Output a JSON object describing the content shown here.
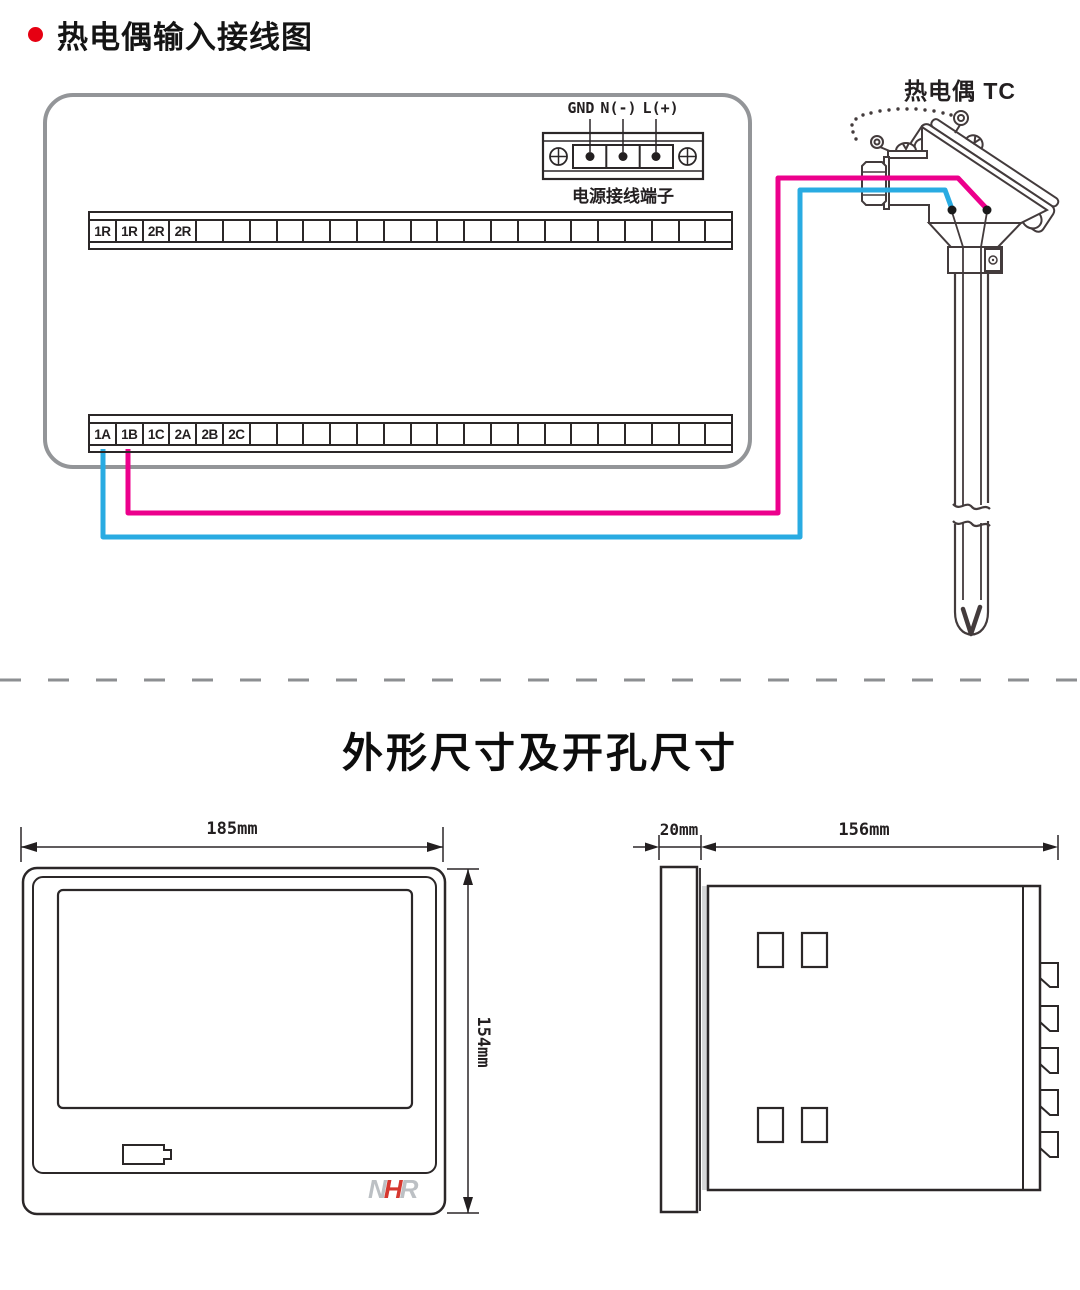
{
  "header": {
    "title": "热电偶输入接线图"
  },
  "wiring": {
    "power_labels": {
      "gnd": "GND",
      "neutral": "N(-)",
      "line": "L(+)"
    },
    "power_caption": "电源接线端子",
    "top_strip": {
      "cells": 24,
      "labels": [
        "1R",
        "1R",
        "2R",
        "2R"
      ]
    },
    "bottom_strip": {
      "cells": 24,
      "labels": [
        "1A",
        "1B",
        "1C",
        "2A",
        "2B",
        "2C"
      ]
    },
    "thermocouple_label": "热电偶 TC"
  },
  "dimensions_section": {
    "title": "外形尺寸及开孔尺寸",
    "front_view": {
      "width_label": "185mm",
      "height_label": "154mm",
      "logo": {
        "n": "N",
        "h": "H",
        "r": "R"
      }
    },
    "side_view": {
      "depth_label": "20mm",
      "body_label": "156mm"
    }
  },
  "colors": {
    "wire_cyan": "#29abe2",
    "wire_magenta": "#ec008c",
    "bullet_red": "#e60012",
    "panel_grey": "#939598",
    "logo_grey": "#bcc0c4",
    "logo_red": "#d6372f"
  }
}
